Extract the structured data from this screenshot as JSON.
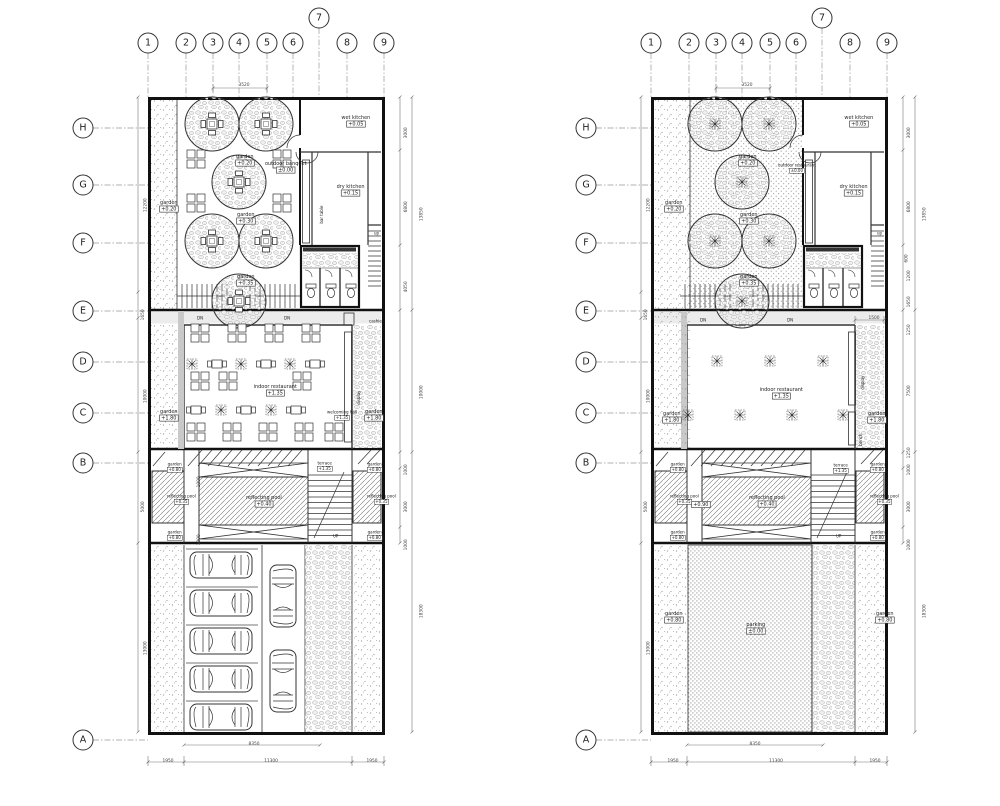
{
  "sheet": {
    "background": "#ffffff",
    "ink": "#333333",
    "wall_ink": "#111111"
  },
  "grid": {
    "cols": [
      "1",
      "2",
      "3",
      "4",
      "5",
      "6",
      "7",
      "8",
      "9"
    ],
    "rows": [
      "H",
      "G",
      "F",
      "E",
      "D",
      "C",
      "B",
      "A"
    ],
    "bubbles": [
      {
        "x": 148,
        "y": 43,
        "t": "1"
      },
      {
        "x": 186,
        "y": 43,
        "t": "2"
      },
      {
        "x": 213,
        "y": 43,
        "t": "3"
      },
      {
        "x": 239,
        "y": 43,
        "t": "4"
      },
      {
        "x": 267,
        "y": 43,
        "t": "5"
      },
      {
        "x": 293,
        "y": 43,
        "t": "6"
      },
      {
        "x": 319,
        "y": 18,
        "t": "7"
      },
      {
        "x": 347,
        "y": 43,
        "t": "8"
      },
      {
        "x": 384,
        "y": 43,
        "t": "9"
      },
      {
        "x": 83,
        "y": 128,
        "t": "H"
      },
      {
        "x": 83,
        "y": 185,
        "t": "G"
      },
      {
        "x": 83,
        "y": 243,
        "t": "F"
      },
      {
        "x": 83,
        "y": 311,
        "t": "E"
      },
      {
        "x": 83,
        "y": 362,
        "t": "D"
      },
      {
        "x": 83,
        "y": 413,
        "t": "C"
      },
      {
        "x": 83,
        "y": 463,
        "t": "B"
      },
      {
        "x": 83,
        "y": 740,
        "t": "A"
      },
      {
        "x": 651,
        "y": 43,
        "t": "1"
      },
      {
        "x": 689,
        "y": 43,
        "t": "2"
      },
      {
        "x": 716,
        "y": 43,
        "t": "3"
      },
      {
        "x": 742,
        "y": 43,
        "t": "4"
      },
      {
        "x": 770,
        "y": 43,
        "t": "5"
      },
      {
        "x": 796,
        "y": 43,
        "t": "6"
      },
      {
        "x": 822,
        "y": 18,
        "t": "7"
      },
      {
        "x": 850,
        "y": 43,
        "t": "8"
      },
      {
        "x": 887,
        "y": 43,
        "t": "9"
      },
      {
        "x": 586,
        "y": 128,
        "t": "H"
      },
      {
        "x": 586,
        "y": 185,
        "t": "G"
      },
      {
        "x": 586,
        "y": 243,
        "t": "F"
      },
      {
        "x": 586,
        "y": 311,
        "t": "E"
      },
      {
        "x": 586,
        "y": 362,
        "t": "D"
      },
      {
        "x": 586,
        "y": 413,
        "t": "C"
      },
      {
        "x": 586,
        "y": 463,
        "t": "B"
      },
      {
        "x": 586,
        "y": 740,
        "t": "A"
      }
    ]
  },
  "annotations": [
    {
      "x": 163,
      "y": 202,
      "t": "garden",
      "b": "+0.20",
      "name": "label-garden-strip-left"
    },
    {
      "x": 239,
      "y": 156,
      "t": "garden",
      "b": "+0.20",
      "name": "label-garden-upper"
    },
    {
      "x": 273,
      "y": 163,
      "t": "outdoor banquet",
      "b": "±0.00",
      "name": "label-outdoor-banquet"
    },
    {
      "x": 240,
      "y": 214,
      "t": "garden",
      "b": "+0.30",
      "name": "label-garden-mid"
    },
    {
      "x": 240,
      "y": 276,
      "t": "garden",
      "b": "+0.35",
      "name": "label-garden-lower"
    },
    {
      "x": 347,
      "y": 117,
      "t": "wet kitchen",
      "b": "+0.05",
      "name": "label-wet-kitchen"
    },
    {
      "x": 342,
      "y": 186,
      "t": "dry kitchen",
      "b": "+0.15",
      "name": "label-dry-kitchen"
    },
    {
      "x": 306,
      "y": 201,
      "t": "bar table",
      "r": 1,
      "cls": "sm",
      "name": "label-bar-table"
    },
    {
      "x": 374,
      "y": 231,
      "t": "up",
      "cls": "sm",
      "name": "label-up-kitchen-stair"
    },
    {
      "x": 197,
      "y": 316,
      "t": "DN",
      "cls": "sm",
      "name": "label-dn-left"
    },
    {
      "x": 284,
      "y": 316,
      "t": "DN",
      "cls": "sm",
      "name": "label-dn-right"
    },
    {
      "x": 369,
      "y": 319,
      "t": "cashier",
      "cls": "sm",
      "name": "label-cashier"
    },
    {
      "x": 262,
      "y": 386,
      "t": "indoor restaurant",
      "b": "+1.35",
      "name": "label-indoor-restaurant"
    },
    {
      "x": 327,
      "y": 410,
      "t": "welcoming hall",
      "b": "+1.35",
      "cls": "sm",
      "name": "label-welcoming-hall"
    },
    {
      "x": 347,
      "y": 386,
      "t": "display",
      "r": 1,
      "cls": "sm",
      "name": "label-display"
    },
    {
      "x": 163,
      "y": 411,
      "t": "garden",
      "b": "+1.80",
      "name": "label-garden-midzone-left"
    },
    {
      "x": 368,
      "y": 411,
      "t": "garden",
      "b": "+1.80",
      "name": "label-garden-midzone-right"
    },
    {
      "x": 317,
      "y": 461,
      "t": "terrace",
      "b": "+1.35",
      "cls": "sm",
      "name": "label-terrace"
    },
    {
      "x": 167,
      "y": 462,
      "t": "garden",
      "b": "+0.80",
      "cls": "sm",
      "name": "label-garden-pool"
    },
    {
      "x": 167,
      "y": 494,
      "t": "reflecting pool",
      "b": "+0.35",
      "cls": "sm",
      "name": "label-reflecting-pool-left"
    },
    {
      "x": 167,
      "y": 530,
      "t": "garden",
      "b": "+0.80",
      "cls": "sm",
      "name": "label-garden-pool"
    },
    {
      "x": 253,
      "y": 497,
      "t": "reflecting pool",
      "b": "+0.40",
      "name": "label-reflecting-pool-main"
    },
    {
      "x": 367,
      "y": 462,
      "t": "garden",
      "b": "+0.80",
      "cls": "sm",
      "name": "label-garden-pool"
    },
    {
      "x": 367,
      "y": 494,
      "t": "reflecting pool",
      "b": "+0.35",
      "cls": "sm",
      "name": "label-reflecting-pool-right"
    },
    {
      "x": 367,
      "y": 530,
      "t": "garden",
      "b": "+0.80",
      "cls": "sm",
      "name": "label-garden-pool"
    },
    {
      "x": 333,
      "y": 534,
      "t": "UP",
      "cls": "sm",
      "name": "label-up-terrace-stair"
    },
    {
      "x": 192,
      "y": 472,
      "t": "1000",
      "r": 1,
      "cls": "dim",
      "name": "dim-channel"
    },
    {
      "x": 192,
      "y": 530,
      "t": "1000",
      "r": 1,
      "cls": "dim",
      "name": "dim-channel"
    },
    {
      "x": 240,
      "y": 83,
      "t": "3520",
      "cls": "dim",
      "name": "dim-top"
    },
    {
      "x": 136,
      "y": 194,
      "t": "12200",
      "r": 1,
      "cls": "dim",
      "name": "dim-left"
    },
    {
      "x": 136,
      "y": 305,
      "t": "1650",
      "r": 1,
      "cls": "dim",
      "name": "dim-left"
    },
    {
      "x": 136,
      "y": 385,
      "t": "10000",
      "r": 1,
      "cls": "dim",
      "name": "dim-left"
    },
    {
      "x": 136,
      "y": 497,
      "t": "5000",
      "r": 1,
      "cls": "dim",
      "name": "dim-left"
    },
    {
      "x": 136,
      "y": 637,
      "t": "13000",
      "r": 1,
      "cls": "dim",
      "name": "dim-left"
    },
    {
      "x": 399,
      "y": 123,
      "t": "3000",
      "r": 1,
      "cls": "dim",
      "name": "dim-right"
    },
    {
      "x": 399,
      "y": 197,
      "t": "6800",
      "r": 1,
      "cls": "dim",
      "name": "dim-right"
    },
    {
      "x": 399,
      "y": 277,
      "t": "4050",
      "r": 1,
      "cls": "dim",
      "name": "dim-right"
    },
    {
      "x": 412,
      "y": 203,
      "t": "13850",
      "r": 1,
      "cls": "dim",
      "name": "dim-right-total"
    },
    {
      "x": 412,
      "y": 381,
      "t": "10000",
      "r": 1,
      "cls": "dim",
      "name": "dim-right-total"
    },
    {
      "x": 399,
      "y": 460,
      "t": "1000",
      "r": 1,
      "cls": "dim",
      "name": "dim-right"
    },
    {
      "x": 399,
      "y": 497,
      "t": "3000",
      "r": 1,
      "cls": "dim",
      "name": "dim-right"
    },
    {
      "x": 399,
      "y": 535,
      "t": "1000",
      "r": 1,
      "cls": "dim",
      "name": "dim-right"
    },
    {
      "x": 412,
      "y": 600,
      "t": "18300",
      "r": 1,
      "cls": "dim",
      "name": "dim-right-total"
    },
    {
      "x": 250,
      "y": 742,
      "t": "8350",
      "cls": "dim",
      "name": "dim-bottom"
    },
    {
      "x": 164,
      "y": 759,
      "t": "1950",
      "cls": "dim",
      "name": "dim-bottom"
    },
    {
      "x": 266,
      "y": 759,
      "t": "11300",
      "cls": "dim",
      "name": "dim-bottom"
    },
    {
      "x": 368,
      "y": 759,
      "t": "1950",
      "cls": "dim",
      "name": "dim-bottom"
    },
    {
      "x": 668,
      "y": 202,
      "t": "garden",
      "b": "+0.20",
      "name": "label-garden-strip-left"
    },
    {
      "x": 742,
      "y": 156,
      "t": "garden",
      "b": "+0.20",
      "name": "label-garden-upper"
    },
    {
      "x": 778,
      "y": 163,
      "t": "outdoor restaurant",
      "b": "±0.00",
      "cls": "sm",
      "name": "label-outdoor-restaurant"
    },
    {
      "x": 743,
      "y": 214,
      "t": "garden",
      "b": "+0.30",
      "name": "label-garden-mid"
    },
    {
      "x": 743,
      "y": 276,
      "t": "garden",
      "b": "+0.35",
      "name": "label-garden-lower"
    },
    {
      "x": 850,
      "y": 117,
      "t": "wet kitchen",
      "b": "+0.05",
      "name": "label-wet-kitchen"
    },
    {
      "x": 845,
      "y": 186,
      "t": "dry kitchen",
      "b": "+0.15",
      "name": "label-dry-kitchen"
    },
    {
      "x": 877,
      "y": 231,
      "t": "up",
      "cls": "sm",
      "name": "label-up-kitchen-stair"
    },
    {
      "x": 700,
      "y": 318,
      "t": "DN",
      "cls": "sm",
      "name": "label-dn-left"
    },
    {
      "x": 787,
      "y": 318,
      "t": "DN",
      "cls": "sm",
      "name": "label-dn-right"
    },
    {
      "x": 768,
      "y": 389,
      "t": "indoor restaurant",
      "b": "+1.35",
      "name": "label-indoor-restaurant"
    },
    {
      "x": 851,
      "y": 371,
      "t": "display",
      "r": 1,
      "cls": "sm",
      "name": "label-display"
    },
    {
      "x": 851,
      "y": 429,
      "t": "bench",
      "r": 1,
      "cls": "sm",
      "name": "label-bench"
    },
    {
      "x": 666,
      "y": 413,
      "t": "garden",
      "b": "+1.80",
      "name": "label-garden-midzone-left"
    },
    {
      "x": 871,
      "y": 413,
      "t": "garden",
      "b": "+1.80",
      "name": "label-garden-midzone-right"
    },
    {
      "x": 833,
      "y": 463,
      "t": "terrace",
      "b": "+1.35",
      "cls": "sm",
      "name": "label-terrace"
    },
    {
      "x": 670,
      "y": 462,
      "t": "garden",
      "b": "+0.80",
      "cls": "sm",
      "name": "label-garden-pool"
    },
    {
      "x": 670,
      "y": 494,
      "t": "reflecting pool",
      "b": "+0.35",
      "cls": "sm",
      "name": "label-reflecting-pool-left"
    },
    {
      "x": 670,
      "y": 530,
      "t": "garden",
      "b": "+0.80",
      "cls": "sm",
      "name": "label-garden-pool"
    },
    {
      "x": 756,
      "y": 497,
      "t": "reflecting pool",
      "b": "+0.40",
      "name": "label-reflecting-pool-main"
    },
    {
      "x": 870,
      "y": 462,
      "t": "garden",
      "b": "+0.80",
      "cls": "sm",
      "name": "label-garden-pool"
    },
    {
      "x": 870,
      "y": 494,
      "t": "reflecting pool",
      "b": "+0.35",
      "cls": "sm",
      "name": "label-reflecting-pool-right"
    },
    {
      "x": 870,
      "y": 530,
      "t": "garden",
      "b": "+0.80",
      "cls": "sm",
      "name": "label-garden-pool"
    },
    {
      "x": 836,
      "y": 534,
      "t": "UP",
      "cls": "sm",
      "name": "label-up-terrace-stair"
    },
    {
      "x": 695,
      "y": 502,
      "b": "+0.90",
      "name": "level-channel"
    },
    {
      "x": 750,
      "y": 624,
      "t": "parking",
      "b": "±0.00",
      "name": "label-parking"
    },
    {
      "x": 668,
      "y": 613,
      "t": "garden",
      "b": "+0.80",
      "name": "label-garden-parking-left"
    },
    {
      "x": 879,
      "y": 613,
      "t": "garden",
      "b": "+0.80",
      "name": "label-garden-parking-right"
    },
    {
      "x": 743,
      "y": 83,
      "t": "3520",
      "cls": "dim",
      "name": "dim-top"
    },
    {
      "x": 639,
      "y": 194,
      "t": "12200",
      "r": 1,
      "cls": "dim",
      "name": "dim-left"
    },
    {
      "x": 639,
      "y": 305,
      "t": "1650",
      "r": 1,
      "cls": "dim",
      "name": "dim-left"
    },
    {
      "x": 639,
      "y": 385,
      "t": "10000",
      "r": 1,
      "cls": "dim",
      "name": "dim-left"
    },
    {
      "x": 639,
      "y": 497,
      "t": "5000",
      "r": 1,
      "cls": "dim",
      "name": "dim-left"
    },
    {
      "x": 639,
      "y": 637,
      "t": "13000",
      "r": 1,
      "cls": "dim",
      "name": "dim-left"
    },
    {
      "x": 902,
      "y": 123,
      "t": "3000",
      "r": 1,
      "cls": "dim",
      "name": "dim-right"
    },
    {
      "x": 902,
      "y": 197,
      "t": "6800",
      "r": 1,
      "cls": "dim",
      "name": "dim-right"
    },
    {
      "x": 902,
      "y": 250,
      "t": "600",
      "r": 1,
      "cls": "dim",
      "name": "dim-right"
    },
    {
      "x": 902,
      "y": 266,
      "t": "1200",
      "r": 1,
      "cls": "dim",
      "name": "dim-right"
    },
    {
      "x": 902,
      "y": 292,
      "t": "1650",
      "r": 1,
      "cls": "dim",
      "name": "dim-right"
    },
    {
      "x": 915,
      "y": 203,
      "t": "13850",
      "r": 1,
      "cls": "dim",
      "name": "dim-right-total"
    },
    {
      "x": 902,
      "y": 320,
      "t": "1250",
      "r": 1,
      "cls": "dim",
      "name": "dim-right"
    },
    {
      "x": 902,
      "y": 381,
      "t": "7500",
      "r": 1,
      "cls": "dim",
      "name": "dim-right"
    },
    {
      "x": 902,
      "y": 443,
      "t": "1250",
      "r": 1,
      "cls": "dim",
      "name": "dim-right"
    },
    {
      "x": 902,
      "y": 460,
      "t": "1000",
      "r": 1,
      "cls": "dim",
      "name": "dim-right"
    },
    {
      "x": 902,
      "y": 497,
      "t": "3000",
      "r": 1,
      "cls": "dim",
      "name": "dim-right"
    },
    {
      "x": 902,
      "y": 535,
      "t": "1000",
      "r": 1,
      "cls": "dim",
      "name": "dim-right"
    },
    {
      "x": 915,
      "y": 600,
      "t": "18300",
      "r": 1,
      "cls": "dim",
      "name": "dim-right-total"
    },
    {
      "x": 870,
      "y": 316,
      "t": "1500",
      "cls": "dim",
      "name": "dim-1500"
    },
    {
      "x": 751,
      "y": 742,
      "t": "8350",
      "cls": "dim",
      "name": "dim-bottom"
    },
    {
      "x": 669,
      "y": 759,
      "t": "1950",
      "cls": "dim",
      "name": "dim-bottom"
    },
    {
      "x": 771,
      "y": 759,
      "t": "11300",
      "cls": "dim",
      "name": "dim-bottom"
    },
    {
      "x": 871,
      "y": 759,
      "t": "1950",
      "cls": "dim",
      "name": "dim-bottom"
    }
  ]
}
